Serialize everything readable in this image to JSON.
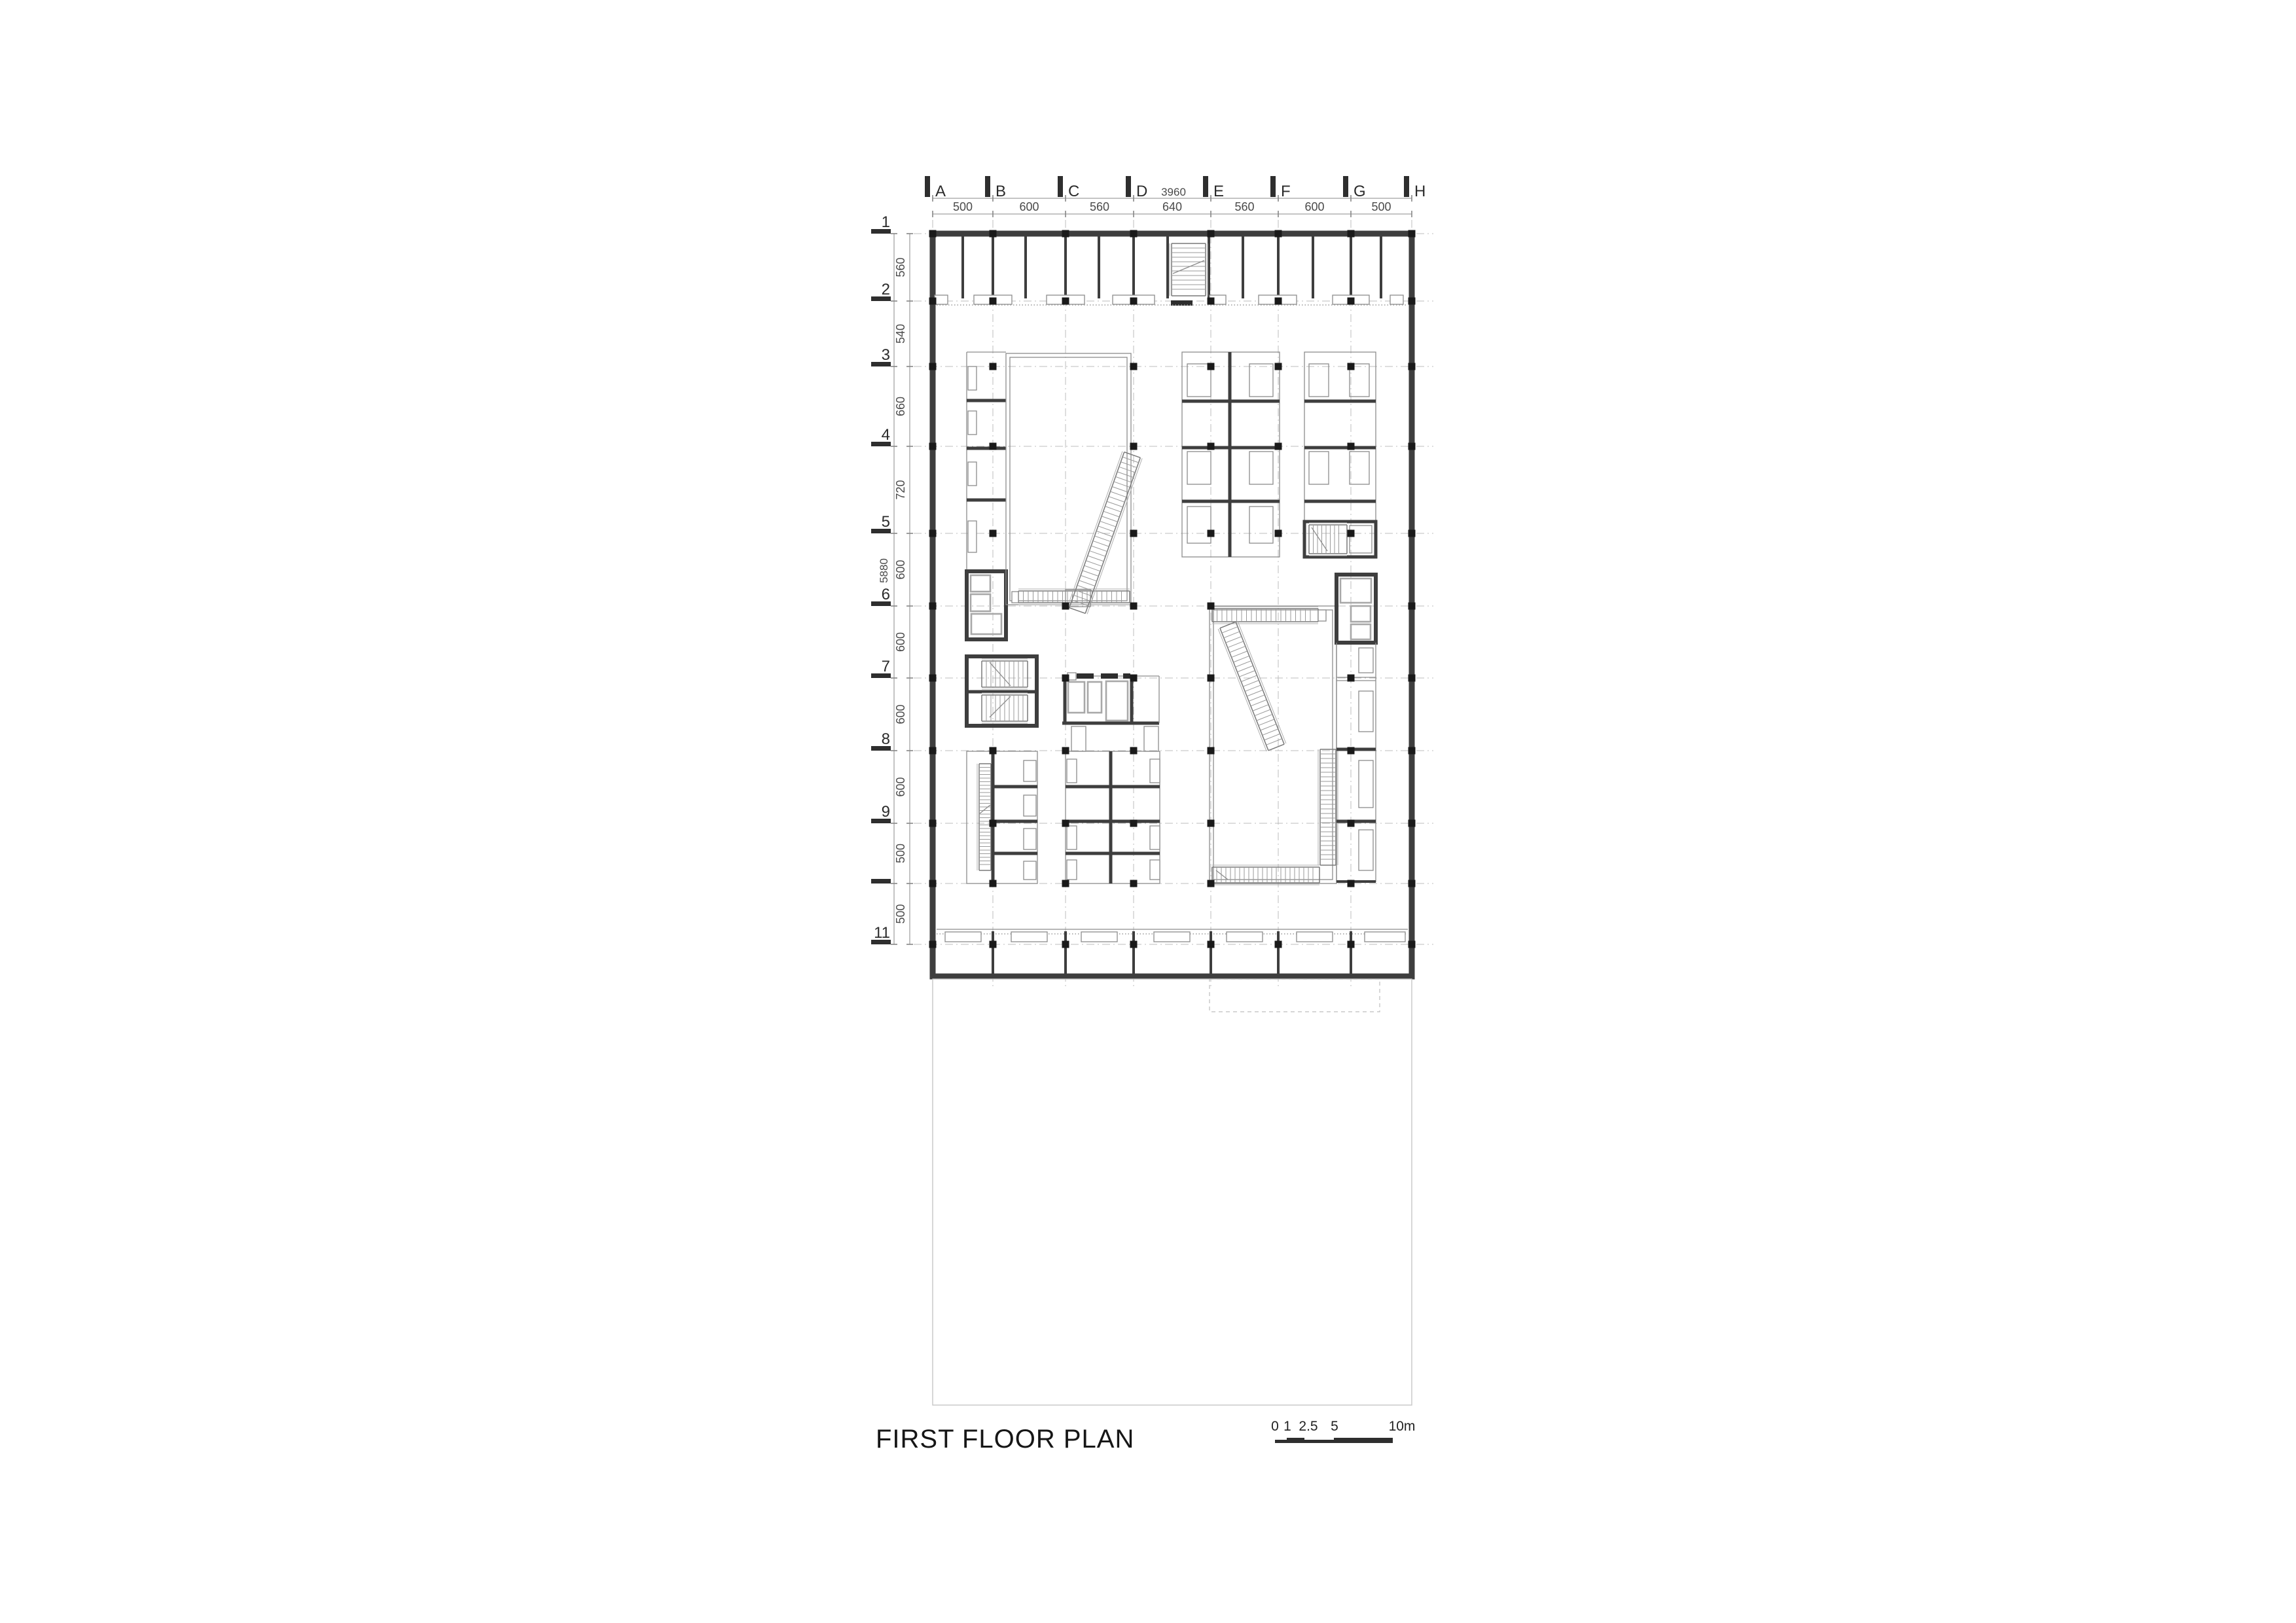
{
  "drawing": {
    "title": "FIRST FLOOR PLAN",
    "grid": {
      "letters": [
        "A",
        "B",
        "C",
        "D",
        "E",
        "F",
        "G",
        "H"
      ],
      "rows": [
        "1",
        "2",
        "3",
        "4",
        "5",
        "6",
        "7",
        "8",
        "9",
        "",
        "11"
      ]
    },
    "dims": {
      "top": [
        "500",
        "600",
        "560",
        "640",
        "560",
        "600",
        "500"
      ],
      "top_total": "3960",
      "side": [
        "560",
        "540",
        "660",
        "720",
        "600",
        "600",
        "600",
        "600",
        "500",
        "500"
      ],
      "side_total": "5880"
    },
    "scale_bar": {
      "labels": [
        "0",
        "1",
        "2.5",
        "5",
        "10m"
      ]
    },
    "accent_colors": {
      "wall": "#3e3e3e",
      "column": "#1a1a1a",
      "thin_line": "#8c8c8c"
    }
  }
}
